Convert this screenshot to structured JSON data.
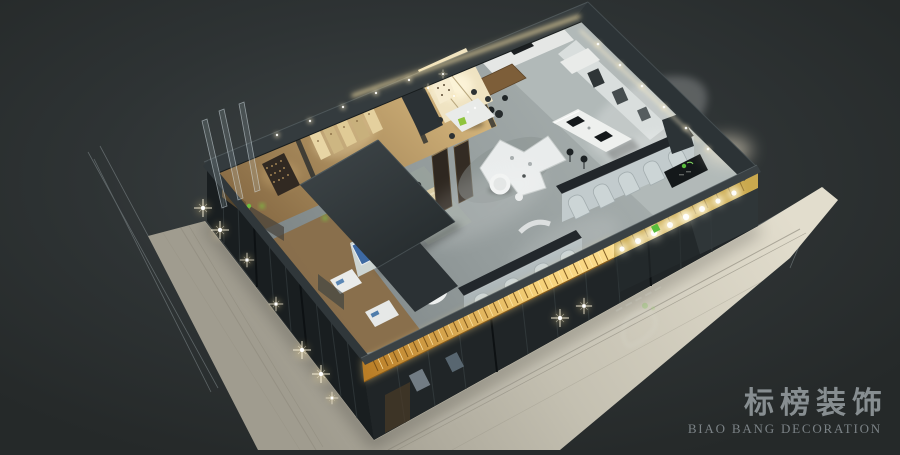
{
  "scene": {
    "type": "3d-isometric-interior-rendering",
    "subject": "night-time dollhouse cutaway of a modern decoration showroom with illuminated storefront"
  },
  "watermark": {
    "brand_cn": "标榜装饰",
    "brand_en": "BIAO BANG DECORATION"
  },
  "colors": {
    "background": "#262a2b",
    "background_glow": "#3e4445",
    "pavement_light": "#ddd9ca",
    "pavement_dark": "#a29e90",
    "wall_dark": "#2b3234",
    "wall_cap": "#394043",
    "floor_concrete": "#98a09f",
    "floor_kitchen": "#b2bab9",
    "wood_warm": "#c8a76d",
    "wood_dark": "#7b5f3c",
    "cabinet_white": "#e7e9e7",
    "panel_wall": "#b7c0c2",
    "amber_glow": "#f6d27a",
    "amber_deep": "#a96f1f",
    "sign_light": "#fff8dd",
    "logo_green": "#59bd3c",
    "art_blue": "#3d69a3",
    "sparkle": "#fff6d9",
    "watermark_text": "#878e91",
    "watermark_sub": "#7b8286"
  }
}
